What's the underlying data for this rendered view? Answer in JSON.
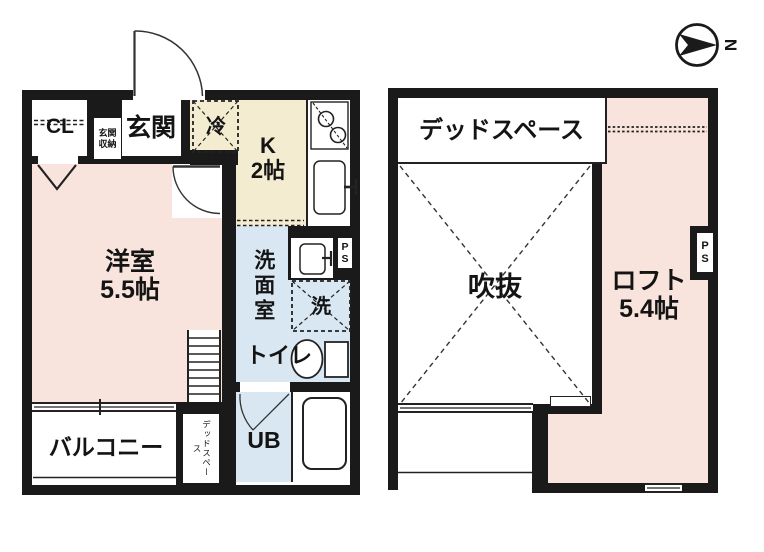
{
  "compass": {
    "north": "N"
  },
  "floor1": {
    "cl": "CL",
    "genkan": "玄関",
    "genkan_shuno": "玄関\n収納",
    "rei": "冷",
    "kitchen": "K\n2帖",
    "yoshitsu": "洋室\n5.5帖",
    "senmenshitsu": "洗面室",
    "sen": "洗",
    "toilet": "トイレ",
    "ub": "UB",
    "balcony": "バルコニー",
    "dead_space": "デッドスペース",
    "ps": "P\nS"
  },
  "floor2": {
    "dead_space": "デッドスペース",
    "fukinuke": "吹抜",
    "loft": "ロフト\n5.4帖",
    "ps": "P\nS"
  },
  "colors": {
    "wall": "#1a1a1a",
    "room_pink": "#F8E4DC",
    "kitchen_cream": "#F4ECD1",
    "wet_blue": "#D9E7F2"
  }
}
